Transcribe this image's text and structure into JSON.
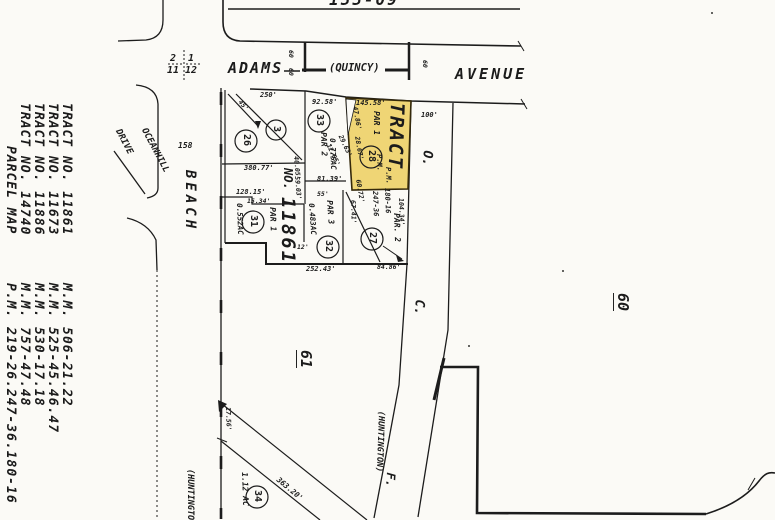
{
  "sheet_number": "155-09",
  "margin_titles": [
    {
      "name": "TRACT NO. 11861",
      "ref": "M.M. 506-21.22"
    },
    {
      "name": "TRACT NO. 11673",
      "ref": "M.M. 525-45.46.47"
    },
    {
      "name": "TRACT NO. 11886",
      "ref": "M.M. 530-17.18"
    },
    {
      "name": "TRACT NO. 14740",
      "ref": "M.M. 757-47.48"
    },
    {
      "name": "PARCEL MAP",
      "ref": "P.M. 219-26.247-36.180-16"
    }
  ],
  "streets": {
    "adams": "ADAMS",
    "quincy_alias": "(QUINCY)",
    "avenue": "AVENUE",
    "beach": "BEACH",
    "oceanhill": "OCEANHILL",
    "drive": "DRIVE",
    "huntington_alias": "(HUNTINGTON)",
    "road_letter_o": "O.",
    "road_letter_c": "C.",
    "road_letter_f": "F.",
    "width_60": "60"
  },
  "section_corner": {
    "top_left": "2",
    "bottom_left": "11",
    "top_right": "1",
    "bottom_right": "12"
  },
  "adjacent_sheets": {
    "left": "158",
    "right": "60",
    "bottom": "61"
  },
  "highlighted_parcel": {
    "tract": "TRACT",
    "par": "PAR 1",
    "number": "28",
    "pm1": "P.M.",
    "pm2": "P.M.",
    "ref1": "247-36",
    "ref2": "180-16"
  },
  "tract_block": {
    "no": "NO.",
    "number": "11861"
  },
  "parcels": {
    "p3": "3",
    "p26": "26",
    "p33": "33",
    "p31": "31",
    "p32": "32",
    "p27": "27",
    "p34": "34",
    "p33_par": "PAR 2",
    "p33_area": "0.775AC",
    "p31_par": "PAR 1",
    "p31_area": "0.552AC",
    "p32_par": "PAR 3",
    "p32_area": "0.483AC",
    "p27_par": "PAR. 2",
    "p34_area": "1.12 AC"
  },
  "dimensions": {
    "d250": "250'",
    "d9258": "92.58'",
    "d14558": "145.58'",
    "d100": "100'",
    "d38077": "380.77'",
    "d12815": "128.15'",
    "d8139": "81.39'",
    "d1534": "15.34'",
    "d55": "55'",
    "d12": "12'",
    "d25243": "252.43'",
    "d8486": "84.86'",
    "d1265": "12.65'",
    "d2963": "29.63'",
    "d4005": "40.05'",
    "d5903": "59.03'",
    "d4786": "47.86'",
    "d2867": "28.67'",
    "d6072": "60.72'",
    "d6741": "67.41'",
    "d10434": "104.34'",
    "d1756": "17.56'",
    "d36320": "363.20'",
    "d45": "45'"
  }
}
